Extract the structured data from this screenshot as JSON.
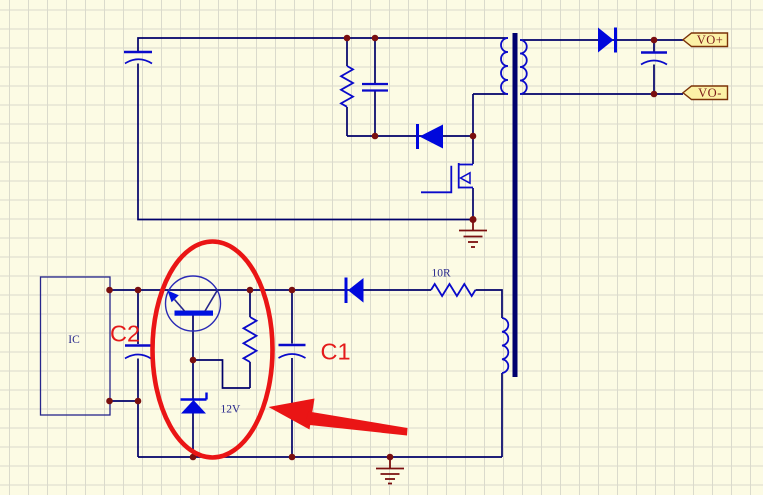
{
  "canvas": {
    "width": 763,
    "height": 495,
    "background": "#FCFBE4",
    "grid_color": "#DADACC",
    "grid_size": 19
  },
  "colors": {
    "wire": "#00006A",
    "component_outline": "#0A0ACA",
    "component_fill": "#0008DC",
    "transformer_core": "#00006E",
    "junction_dot": "#7A0F0F",
    "ground": "#7A0F0F",
    "annotation_red": "#EA1515",
    "red_label": "#E41A1A",
    "flag_fill": "#FCF1A6",
    "flag_border": "#7B3208",
    "flag_text": "#7B1A1A",
    "small_label": "#26268C"
  },
  "labels": {
    "ic": "IC",
    "cap_c2": "C2",
    "cap_c1": "C1",
    "zener_value": "12V",
    "resistor_value": "10R",
    "output_positive": "VO+",
    "output_negative": "VO-"
  },
  "components": [
    {
      "name": "input-filter-capacitor",
      "type": "polarized-capacitor"
    },
    {
      "name": "snubber-resistor",
      "type": "resistor"
    },
    {
      "name": "snubber-capacitor",
      "type": "capacitor"
    },
    {
      "name": "clamp-diode",
      "type": "diode"
    },
    {
      "name": "power-mosfet",
      "type": "n-mosfet"
    },
    {
      "name": "transformer",
      "type": "transformer",
      "windings": [
        "primary",
        "secondary",
        "auxiliary"
      ]
    },
    {
      "name": "output-rectifier-diode",
      "type": "diode"
    },
    {
      "name": "output-filter-capacitor",
      "type": "polarized-capacitor"
    },
    {
      "name": "flag-vo-plus",
      "label": "VO+"
    },
    {
      "name": "flag-vo-minus",
      "label": "VO-"
    },
    {
      "name": "controller-ic",
      "label": "IC"
    },
    {
      "name": "capacitor-c2",
      "label": "C2",
      "type": "polarized-capacitor"
    },
    {
      "name": "bias-transistor",
      "type": "transistor"
    },
    {
      "name": "bias-resistor",
      "type": "resistor"
    },
    {
      "name": "zener-diode",
      "label": "12V",
      "type": "zener"
    },
    {
      "name": "capacitor-c1",
      "label": "C1",
      "type": "polarized-capacitor"
    },
    {
      "name": "aux-rectifier-diode",
      "type": "diode"
    },
    {
      "name": "series-resistor",
      "label": "10R",
      "type": "resistor"
    },
    {
      "name": "primary-ground",
      "type": "ground"
    },
    {
      "name": "aux-ground",
      "type": "ground"
    },
    {
      "name": "highlight-ellipse",
      "type": "red-annotation"
    },
    {
      "name": "pointer-arrow",
      "type": "red-annotation"
    }
  ]
}
